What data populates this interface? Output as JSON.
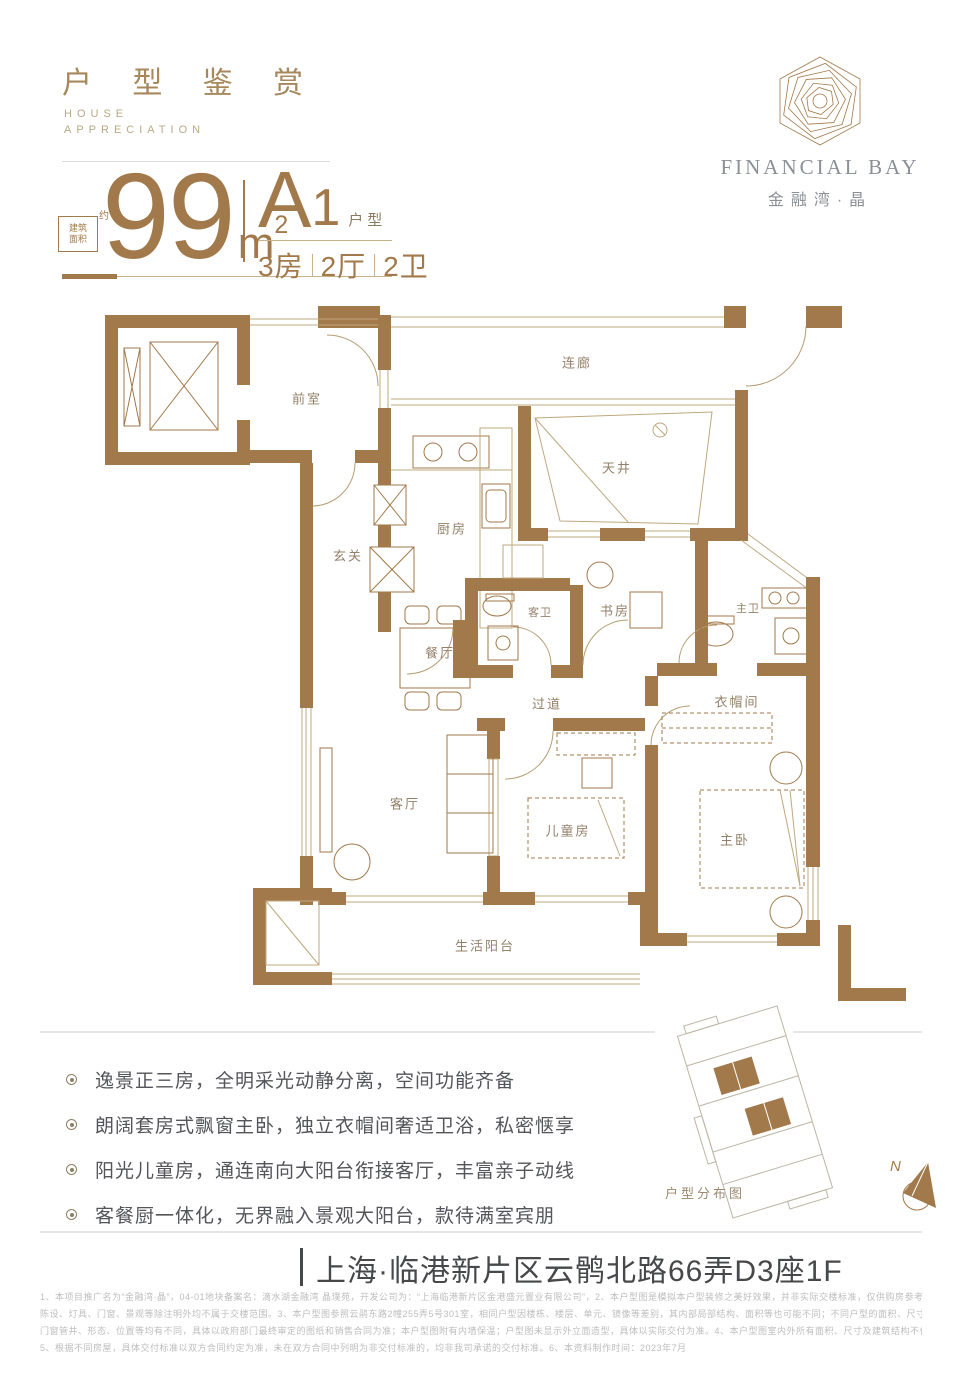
{
  "header": {
    "title": "户 型 鉴 赏",
    "subtitle_line1": "HOUSE",
    "subtitle_line2": "APPRECIATION"
  },
  "brand": {
    "name": "FINANCIAL BAY",
    "cn_name": "金融湾·晶"
  },
  "unit": {
    "area_value": "99",
    "area_unit": "m",
    "area_sup": "2",
    "area_note_line1": "建筑",
    "area_note_line2": "面积",
    "area_note_suffix": "约",
    "type_letter": "A",
    "type_number": "1",
    "type_suffix": "户型",
    "rooms": "3房",
    "halls": "2厅",
    "baths": "2卫"
  },
  "floorplan": {
    "rooms": [
      {
        "label": "前室"
      },
      {
        "label": "连廊"
      },
      {
        "label": "天井"
      },
      {
        "label": "厨房"
      },
      {
        "label": "玄关"
      },
      {
        "label": "客卫"
      },
      {
        "label": "书房"
      },
      {
        "label": "主卫"
      },
      {
        "label": "餐厅"
      },
      {
        "label": "过道"
      },
      {
        "label": "衣帽间"
      },
      {
        "label": "客厅"
      },
      {
        "label": "儿童房"
      },
      {
        "label": "主卧"
      },
      {
        "label": "生活阳台"
      }
    ]
  },
  "highlights": {
    "items": [
      "逸景正三房，全明采光动静分离，空间功能齐备",
      "朗阔套房式飘窗主卧，独立衣帽间奢适卫浴，私密惬享",
      "阳光儿童房，通连南向大阳台衔接客厅，丰富亲子动线",
      "客餐厨一体化，无界融入景观大阳台，款待满室宾朋"
    ]
  },
  "sitemap": {
    "caption": "户型分布图",
    "compass_label": "N"
  },
  "address": {
    "text": "上海·临港新片区云鹘北路66弄D3座1F"
  },
  "disclaimer": {
    "lines": [
      "1、本项目推广名为“金融湾·晶”，04-01地块备案名：滴水湖金融湾 晶璞苑，开发公司为：“上海临港新片区金港盛元置业有限公司”，2、本户型图是模拟本户型装修之美好效果，并非实际交楼标准，仅供购房参考，室内装修、家具、",
      "陈设、灯具、门窗、景观等除注明外均不属于交楼范围。3、本户型图参照云鹃东路2幢255弄5号301室，相同户型因楼栋、楼层、单元、镜像等差别，其内部局部结构、面积等也可能不同；不同户型的面积、尺寸、功能布局、空间分割、",
      "门窗管井、形态、位置等均有不同，具体以政府部门最终审定的图纸和销售合同为准；本户型图附有内墙保温；户型图未显示外立面造型，具体以实际交付为准。4、本户型图室内外所有面积、尺寸及建筑结构不作为实际交付衡量之基准。",
      "5、根据不同房屋，具体交付标准以双方合同约定为准，未在双方合同中列明为非交付标准的，均非我司承诺的交付标准。6、本资料制作时间：2023年7月"
    ]
  },
  "colors": {
    "accent": "#A1794A",
    "text_dark": "#54555A",
    "text_light": "#BDBDBD"
  }
}
